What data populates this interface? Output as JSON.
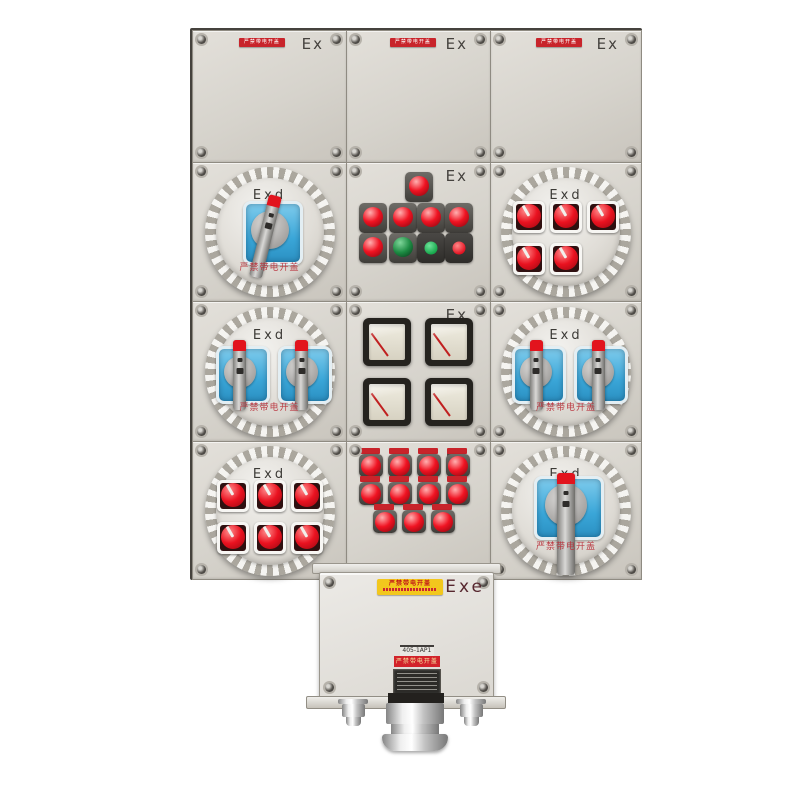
{
  "marks": {
    "ex": "Ex",
    "exd": "Exd",
    "exe": "Exe"
  },
  "texts": {
    "warning_strip": "严禁带电开盖",
    "cover_warning": "严禁带电开盖",
    "yellow_label": "严禁带电开盖",
    "model_label": "405-1AP1",
    "red_label": "严禁带电开盖"
  },
  "colors": {
    "warning_red": "#c8242b",
    "button_red": "#ea1220",
    "button_green": "#1c8a42",
    "window_blue": "#3aa6d8",
    "yellow_label_bg": "#f2c71d",
    "exe_maroon": "#56262e",
    "mark_gray": "#45423e"
  },
  "grid_rows": [
    [
      {
        "type": "blank"
      },
      {
        "type": "blank"
      },
      {
        "type": "blank"
      }
    ],
    [
      {
        "type": "rotary",
        "windows": 1,
        "handle": "diagonal"
      },
      {
        "type": "pilot-panel",
        "top_lights": 1,
        "indicator_lights": [
          "red",
          "red",
          "red",
          "red"
        ],
        "buttons": [
          "red-dome",
          "green-dome",
          "green-flat",
          "red-flat"
        ]
      },
      {
        "type": "switch-grid",
        "rows": [
          3,
          2
        ]
      }
    ],
    [
      {
        "type": "rotary",
        "windows": 2,
        "handle": "vertical"
      },
      {
        "type": "meter-panel",
        "meters": 4
      },
      {
        "type": "rotary",
        "windows": 2,
        "handle": "vertical"
      }
    ],
    [
      {
        "type": "switch-grid",
        "rows": [
          3,
          3
        ]
      },
      {
        "type": "button-grid",
        "rows": [
          4,
          4,
          3
        ],
        "labels": true
      },
      {
        "type": "rotary",
        "windows": 1,
        "handle": "long-vertical"
      }
    ]
  ]
}
